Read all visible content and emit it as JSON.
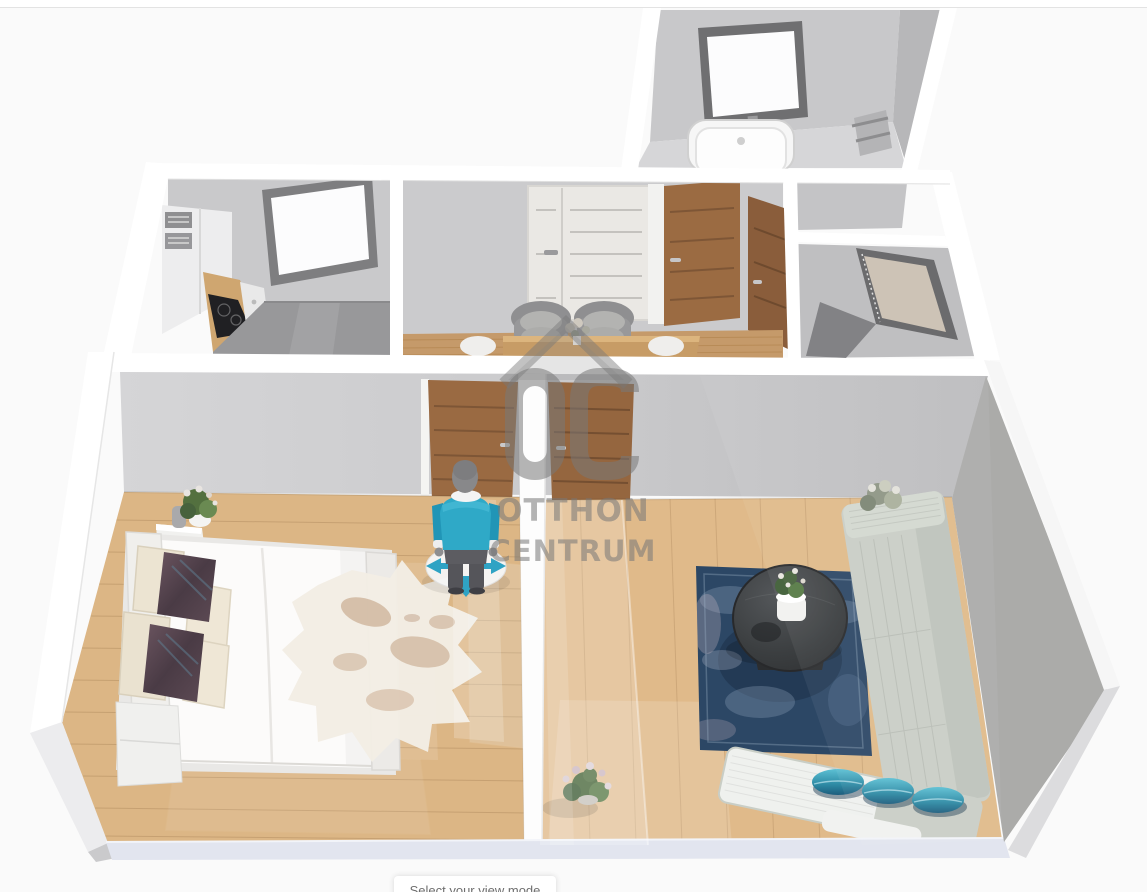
{
  "watermark": {
    "logo_text": "OC",
    "line1": "OTTHON",
    "line2": "CENTRUM",
    "color": "#787878"
  },
  "view_mode_panel": {
    "label": "Select your view mode"
  },
  "avatar": {
    "shirt_color": "#2fa9c7",
    "pants_color": "#55555a",
    "teleport_arrow_color": "#2fa3c4"
  },
  "palette": {
    "background": "#fafafa",
    "wall_top": "#ffffff",
    "wall_face": "#cbcbcd",
    "wood_floor_bedroom": "#dcb685",
    "wood_floor_living": "#e0ba8a",
    "wood_floor_hall": "#c59a6a",
    "kitchen_floor_gray": "#98989a",
    "door_brown": "#9a6a42",
    "sofa_gray": "#c9cec6",
    "rug_blue": "#2c4765",
    "pillow_teal": "#2d8aa4"
  },
  "scene": {
    "rooms": [
      "bathroom",
      "kitchen",
      "hallway",
      "wardrobe-room",
      "bedroom",
      "living-room"
    ]
  }
}
